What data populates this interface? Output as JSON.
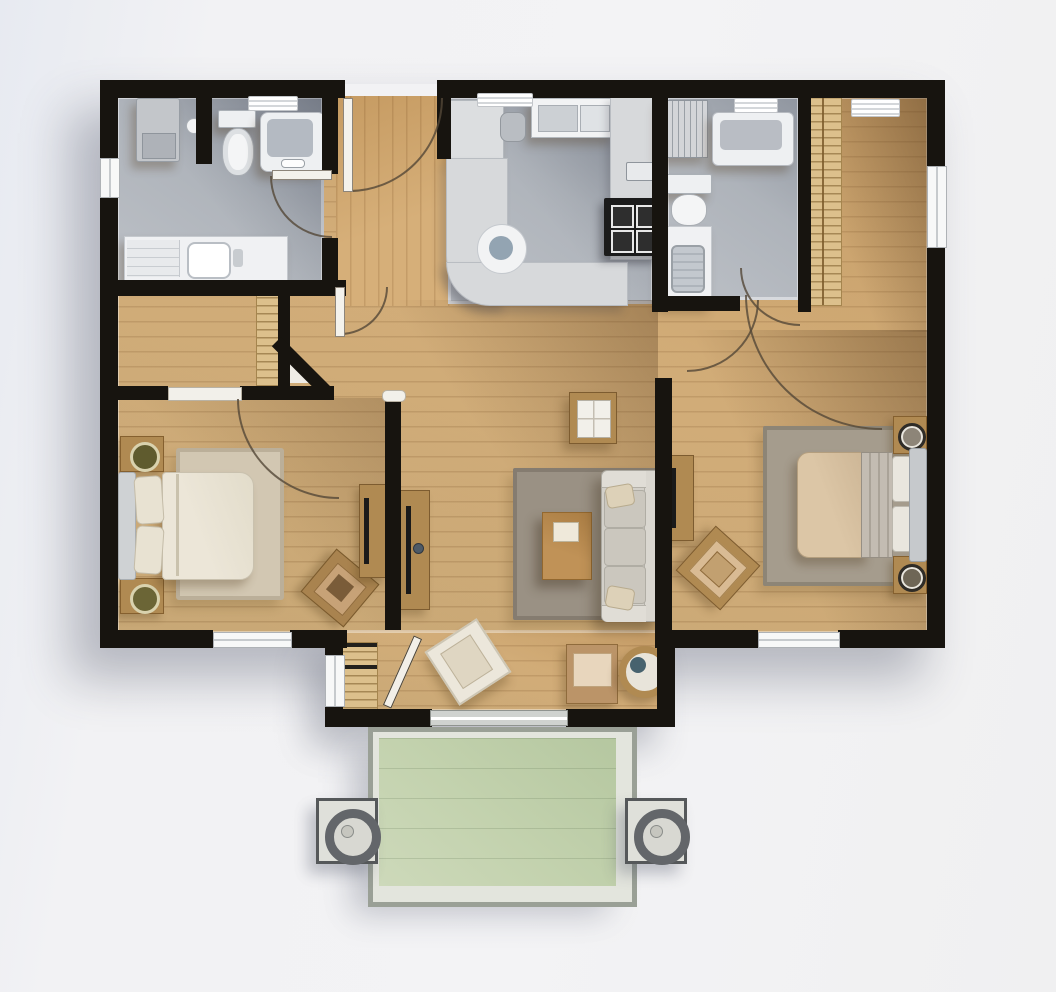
{
  "meta": {
    "kind": "architectural floor plan",
    "view": "top-down 3D render",
    "text_labels": []
  },
  "palette": {
    "background": "#f3f3f5",
    "wall": "#17140f",
    "wood_floor": "#cda46f",
    "tile_floor": "#aab0b8",
    "counter": "#d7d9db",
    "fixture_white": "#f1f2f4",
    "patio_green": "#c3d2ae",
    "patio_frame": "#9aa096",
    "rug_living": "#9a9184",
    "rug_bedroom1": "#d2c7b2",
    "rug_bedroom2": "#a59c8d",
    "furniture_wood": "#b08a52",
    "bedding_cream": "#ece6d8",
    "bedding_tan": "#dcc6a6",
    "sofa_gray": "#d3d0c9",
    "accent_dark_teal": "#47626e"
  },
  "rooms": [
    {
      "id": "bathroom-1",
      "position": "top-left",
      "floor": "gray tile",
      "contents": [
        "stacked-washer-dryer",
        "toilet",
        "bathtub",
        "vanity-with-sink",
        "toilet-paper-holder",
        "ceiling-vent",
        "door-swing"
      ]
    },
    {
      "id": "entry-hall",
      "position": "top-center-left",
      "floor": "wood",
      "contents": [
        "entry-door-swing"
      ]
    },
    {
      "id": "kitchen",
      "position": "top-center",
      "floor": "gray tile",
      "contents": [
        "u-shaped-counter",
        "round-sink",
        "cooktop-4-burner",
        "tall-cabinet",
        "canister",
        "counter-sink-module",
        "ceiling-vent"
      ]
    },
    {
      "id": "bathroom-2",
      "position": "top-right-center",
      "floor": "gray tile",
      "contents": [
        "bathtub",
        "toilet",
        "vanity-with-sink",
        "towel-rack",
        "ceiling-vent",
        "door-swing"
      ]
    },
    {
      "id": "hallway",
      "position": "mid-left",
      "floor": "wood",
      "contents": [
        "slatted-shelf",
        "angled-wall",
        "door-swing"
      ]
    },
    {
      "id": "bedroom-1",
      "position": "left",
      "floor": "wood",
      "contents": [
        "double-bed",
        "nightstand-with-plant-x2",
        "area-rug",
        "armchair",
        "tv-console",
        "window-south",
        "door-swing"
      ]
    },
    {
      "id": "living-room",
      "position": "center",
      "floor": "wood",
      "contents": [
        "sofa-3-seat",
        "coffee-table",
        "side-table-with-tray",
        "area-rug",
        "tv-console",
        "armchair-x2",
        "round-side-table",
        "slatted-shelf",
        "sliding-patio-door"
      ]
    },
    {
      "id": "bedroom-2",
      "position": "right",
      "floor": "wood",
      "contents": [
        "double-bed",
        "nightstand-with-decor-x2",
        "area-rug",
        "armchair",
        "tv-console",
        "tall-slatted-closet",
        "window-east",
        "window-south",
        "door-swings"
      ]
    },
    {
      "id": "patio",
      "position": "bottom-center",
      "floor": "green deck",
      "contents": [
        "deck-frame",
        "planter-column-left",
        "planter-column-right"
      ]
    }
  ]
}
